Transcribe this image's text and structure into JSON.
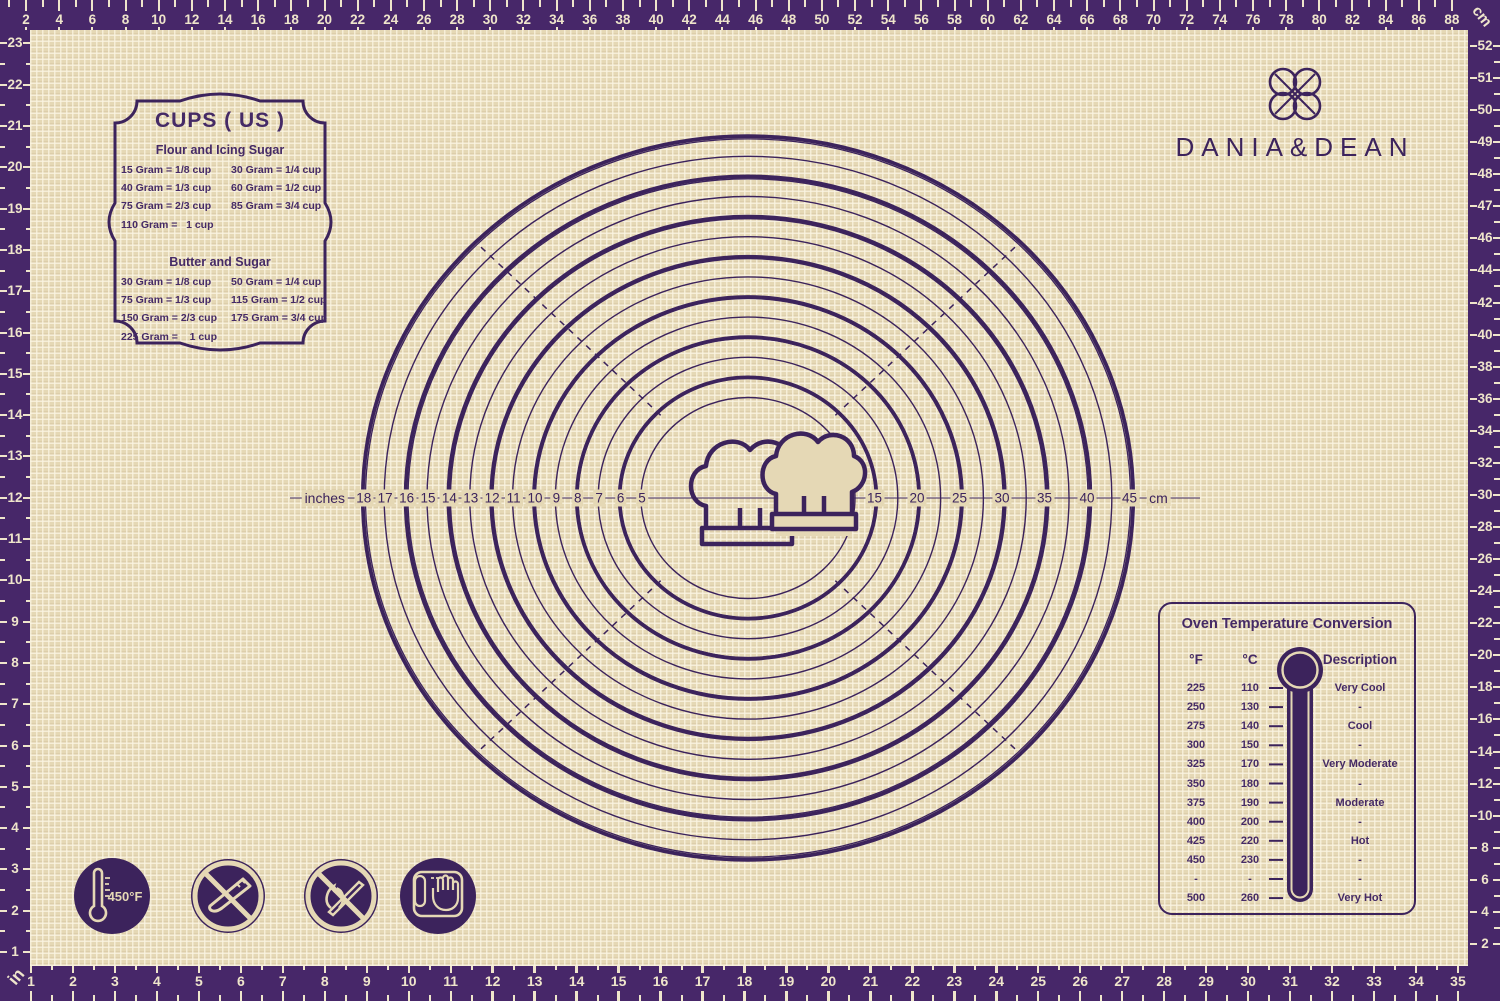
{
  "brand": {
    "name": "DANIA&DEAN",
    "emblem": "four-ring-knot"
  },
  "colors": {
    "frame_purple": "#472769",
    "ink_purple": "#3c235c",
    "mat_beige": "#e5d8b5",
    "ruler_cream": "#efe5cb"
  },
  "rulers": {
    "top_cm": {
      "unit": "cm",
      "labels": [
        2,
        4,
        6,
        8,
        10,
        12,
        14,
        16,
        18,
        20,
        22,
        24,
        26,
        28,
        30,
        32,
        34,
        36,
        38,
        40,
        42,
        44,
        46,
        48,
        50,
        52,
        54,
        56,
        58,
        60,
        62,
        64,
        66,
        68,
        70,
        72,
        74,
        76,
        78,
        80,
        82,
        84,
        86,
        88
      ]
    },
    "bottom_in": {
      "unit": "in",
      "labels": [
        1,
        2,
        3,
        4,
        5,
        6,
        7,
        8,
        9,
        10,
        11,
        12,
        13,
        14,
        15,
        16,
        17,
        18,
        19,
        20,
        21,
        22,
        23,
        24,
        25,
        26,
        27,
        28,
        29,
        30,
        31,
        32,
        33,
        34,
        35
      ]
    },
    "left_in": {
      "unit": "in",
      "labels": [
        23,
        22,
        21,
        20,
        19,
        18,
        17,
        16,
        15,
        14,
        13,
        12,
        11,
        10,
        9,
        8,
        7,
        6,
        5,
        4,
        3,
        2,
        1
      ]
    },
    "right_cm": {
      "unit": "cm",
      "labels": [
        52,
        51,
        50,
        49,
        48,
        47,
        46,
        44,
        42,
        40,
        38,
        36,
        34,
        32,
        30,
        28,
        26,
        24,
        22,
        20,
        18,
        16,
        14,
        12,
        10,
        8,
        6,
        4,
        2
      ]
    },
    "corner_unit_top_right": "cm",
    "corner_unit_bottom_left": "in"
  },
  "cups_panel": {
    "title": "CUPS ( US )",
    "sections": [
      {
        "heading": "Flour and Icing Sugar",
        "rows": [
          [
            "15 Gram = 1/8 cup",
            "30 Gram = 1/4 cup"
          ],
          [
            "40 Gram = 1/3 cup",
            "60 Gram = 1/2 cup"
          ],
          [
            "75 Gram = 2/3 cup",
            "85 Gram = 3/4 cup"
          ],
          [
            "110 Gram =   1 cup",
            ""
          ]
        ]
      },
      {
        "heading": "Butter and Sugar",
        "rows": [
          [
            "30 Gram = 1/8 cup",
            "50 Gram = 1/4 cup"
          ],
          [
            "75 Gram = 1/3 cup",
            "115 Gram = 1/2 cup"
          ],
          [
            "150 Gram = 2/3 cup",
            "175 Gram = 3/4 cup"
          ],
          [
            "225 Gram =    1 cup",
            ""
          ]
        ]
      }
    ]
  },
  "circle_gauge": {
    "inch_axis_label": "inches",
    "cm_axis_label": "cm",
    "inch_diameters": [
      18,
      17,
      16,
      15,
      14,
      13,
      12,
      11,
      10,
      9,
      8,
      7,
      6,
      5
    ],
    "cm_diameters": [
      15,
      20,
      25,
      30,
      35,
      40,
      45
    ],
    "center_icon": "double-chef-hats"
  },
  "oven_table": {
    "title": "Oven Temperature Conversion",
    "columns": [
      "°F",
      "°C",
      "Description"
    ],
    "rows": [
      [
        "225",
        "110",
        "Very Cool"
      ],
      [
        "250",
        "130",
        "-"
      ],
      [
        "275",
        "140",
        "Cool"
      ],
      [
        "300",
        "150",
        "-"
      ],
      [
        "325",
        "170",
        "Very Moderate"
      ],
      [
        "350",
        "180",
        "-"
      ],
      [
        "375",
        "190",
        "Moderate"
      ],
      [
        "400",
        "200",
        "-"
      ],
      [
        "425",
        "220",
        "Hot"
      ],
      [
        "450",
        "230",
        "-"
      ],
      [
        "-",
        "-",
        "-"
      ],
      [
        "500",
        "260",
        "Very Hot"
      ]
    ]
  },
  "care_icons": [
    {
      "name": "max-temperature-icon",
      "label": "450°F"
    },
    {
      "name": "no-knife-icon",
      "label": ""
    },
    {
      "name": "no-open-flame-icon",
      "label": ""
    },
    {
      "name": "hand-wash-icon",
      "label": ""
    }
  ]
}
